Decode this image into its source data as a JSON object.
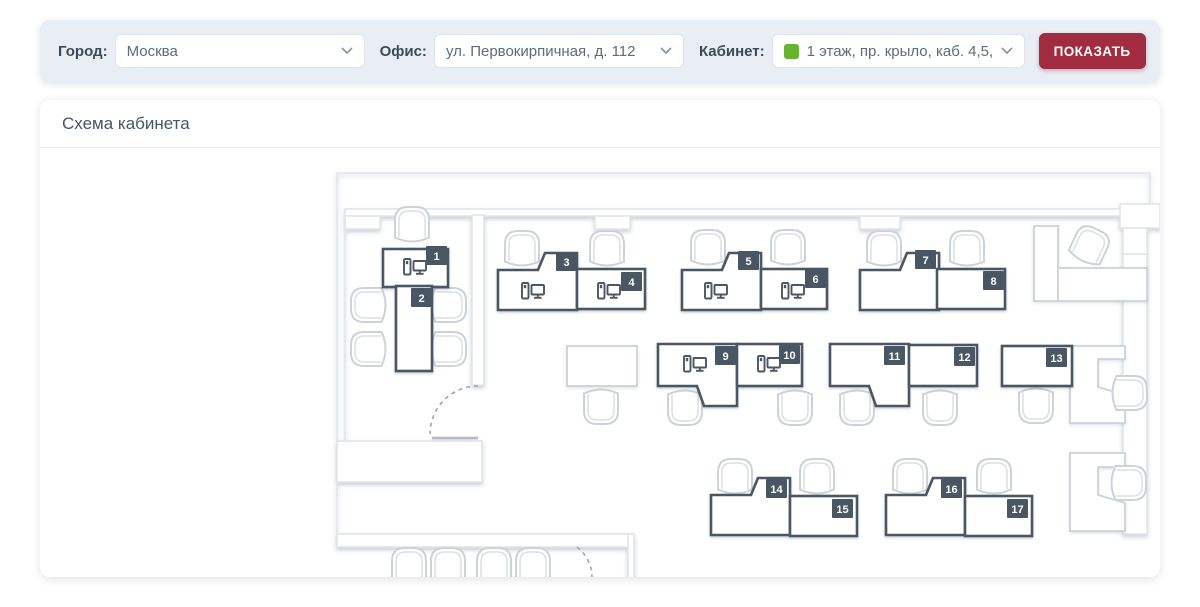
{
  "toolbar": {
    "fields": [
      {
        "label": "Город:",
        "value": "Москва"
      },
      {
        "label": "Офис:",
        "value": "ул. Первокирпичная, д. 112"
      },
      {
        "label": "Кабинет:",
        "value": "1 этаж, пр. крыло, каб. 4,5,П",
        "marker_color": "#65b32e"
      }
    ],
    "show_button": "ПОКАЗАТЬ",
    "button_color": "#a12c3f"
  },
  "panel": {
    "title": "Схема кабинета"
  },
  "plan": {
    "desks": [
      {
        "number": "1",
        "has_computer": true
      },
      {
        "number": "2",
        "has_computer": false
      },
      {
        "number": "3",
        "has_computer": true
      },
      {
        "number": "4",
        "has_computer": true
      },
      {
        "number": "5",
        "has_computer": true
      },
      {
        "number": "6",
        "has_computer": true
      },
      {
        "number": "7",
        "has_computer": false
      },
      {
        "number": "8",
        "has_computer": false
      },
      {
        "number": "9",
        "has_computer": true
      },
      {
        "number": "10",
        "has_computer": true
      },
      {
        "number": "11",
        "has_computer": false
      },
      {
        "number": "12",
        "has_computer": false
      },
      {
        "number": "13",
        "has_computer": false
      },
      {
        "number": "14",
        "has_computer": false
      },
      {
        "number": "15",
        "has_computer": false
      },
      {
        "number": "16",
        "has_computer": false
      },
      {
        "number": "17",
        "has_computer": false
      }
    ],
    "colors": {
      "desk_outline": "#4a5663",
      "badge_background": "#4a5663",
      "badge_text": "#ffffff",
      "furniture_outline": "#ccd2d8",
      "wall_outline": "#e0e4e8"
    }
  },
  "icons": {
    "dropdown_chevron": "chevron-down",
    "workstation": "pc-with-monitor",
    "room_marker": "green-square"
  }
}
